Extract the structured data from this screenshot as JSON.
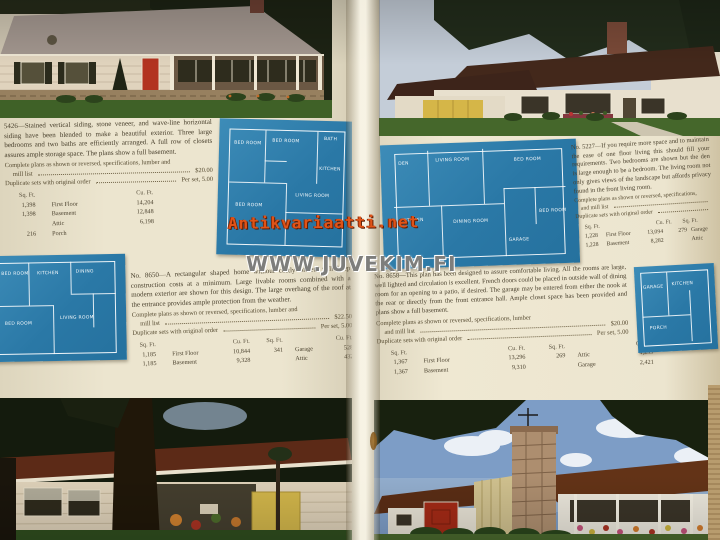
{
  "colors": {
    "blueprint_blue": "#2a78a6",
    "page_cream": "#e8e1cb",
    "watermark_orange": "#e05318",
    "watermark_gray": "#7e7e7c"
  },
  "watermarks": {
    "antikvariaatti": "Antikvariaatti.net",
    "juvekim": "WWW.JUVEKIM.FI"
  },
  "left_page": {
    "listing_5426": {
      "para": "5426—Stained vertical siding, stone veneer, and wave-line horizontal siding have been blended to make a beautiful exterior. Three large bedrooms and two baths are efficiently arranged. A full row of closets assures ample storage space. The plans show a full basement.",
      "price_line1a": "Complete plans as shown or reversed, specifications, lumber and",
      "price_line1b": "mill list",
      "price1": "$20.00",
      "price_line2": "Duplicate sets with original order",
      "price2": "Per set,  5.00",
      "h_sqft": "Sq. Ft.",
      "h_cuft": "Cu. Ft.",
      "rows": [
        {
          "sqft": "1,398",
          "label": "First Floor",
          "cuft": "14,204"
        },
        {
          "sqft": "1,398",
          "label": "Basement",
          "cuft": "12,848"
        },
        {
          "sqft": "",
          "label": "Attic",
          "cuft": "6,198"
        },
        {
          "sqft": "216",
          "label": "Porch",
          "cuft": ""
        }
      ]
    },
    "listing_8650": {
      "para": "No. 8650—A rectangular shaped home without costly offsets will keep construction costs at a minimum. Large livable rooms combined with a modern exterior are shown for this design. The large overhang of the roof at the entrance provides ample protection from the weather.",
      "price_line1a": "Complete plans as shown or reversed, specifications, lumber and",
      "price_line1b": "mill list",
      "price1": "$22.50",
      "price_line2": "Duplicate sets with original order",
      "price2": "Per set,  5.00",
      "h_sqft": "Sq. Ft.",
      "h_cuft": "Cu. Ft.",
      "h_sqft2": "Sq. Ft.",
      "h_cuft2": "Cu. Ft.",
      "rows": [
        {
          "sqft": "1,185",
          "label": "First Floor",
          "cuft": "10,844",
          "sqft2": "341",
          "label2": "Garage",
          "cuft2": "528"
        },
        {
          "sqft": "1,185",
          "label": "Basement",
          "cuft": "9,328",
          "sqft2": "",
          "label2": "Attic",
          "cuft2": "432"
        }
      ]
    }
  },
  "right_page": {
    "listing_5227": {
      "para": "No. 5227—If you require more space and to maintain the ease of one floor living this should fill your requirements. Two bedrooms are shown but the den is large enough to be a bedroom. The living room not only gives views of the landscape but affords privacy found in the front living room.",
      "price_line1a": "Complete plans as shown or reversed, specifications,",
      "price_line1b": "and mill list",
      "price_line2": "Duplicate sets with original order",
      "h_sqft": "Sq. Ft.",
      "h_cuft": "Cu. Ft.",
      "h_sqft2": "Sq. Ft.",
      "rows": [
        {
          "sqft": "1,228",
          "label": "First Floor",
          "cuft": "13,094",
          "sqft2": "279",
          "label2": "Garage"
        },
        {
          "sqft": "1,228",
          "label": "Basement",
          "cuft": "8,282",
          "sqft2": "",
          "label2": "Attic"
        }
      ]
    },
    "listing_8658": {
      "para": "No. 8658—This plan has been designed to assure comfortable living. All the rooms are large, well lighted and circulation is excellent. French doors could be placed in outside wall of dining room for an opening to a patio, if desired. The garage may be entered from either the nook at the rear or directly from the front entrance hall. Ample closet space has been provided and plans show a full basement.",
      "price_line1a": "Complete plans as shown or reversed, specifications, lumber",
      "price_line1b": "and mill list",
      "price1": "$20.00",
      "price_line2": "Duplicate sets with original order",
      "price2": "Per set,  5.00",
      "h_sqft": "Sq. Ft.",
      "h_cuft": "Cu. Ft.",
      "h_sqft2": "Sq. Ft.",
      "h_cuft2": "Cu. Ft.",
      "rows": [
        {
          "sqft": "1,367",
          "label": "First Floor",
          "cuft": "13,296",
          "sqft2": "269",
          "label2": "Attic",
          "cuft2": "4,299"
        },
        {
          "sqft": "1,367",
          "label": "Basement",
          "cuft": "9,310",
          "sqft2": "",
          "label2": "Garage",
          "cuft2": "2,421"
        }
      ]
    }
  },
  "blueprints": {
    "plan_a": {
      "labels": [
        "BED ROOM",
        "BED ROOM",
        "BATH",
        "KITCHEN",
        "LIVING ROOM",
        "BED ROOM"
      ]
    },
    "plan_b": {
      "labels": [
        "BED ROOM",
        "KITCHEN",
        "DINING",
        "BED ROOM",
        "LIVING ROOM"
      ]
    },
    "plan_c": {
      "labels": [
        "DEN",
        "LIVING ROOM",
        "BED ROOM",
        "KITCHEN",
        "DINING ROOM",
        "BED ROOM",
        "GARAGE"
      ]
    },
    "plan_d": {
      "labels": [
        "GARAGE",
        "KITCHEN",
        "PORCH"
      ]
    }
  }
}
